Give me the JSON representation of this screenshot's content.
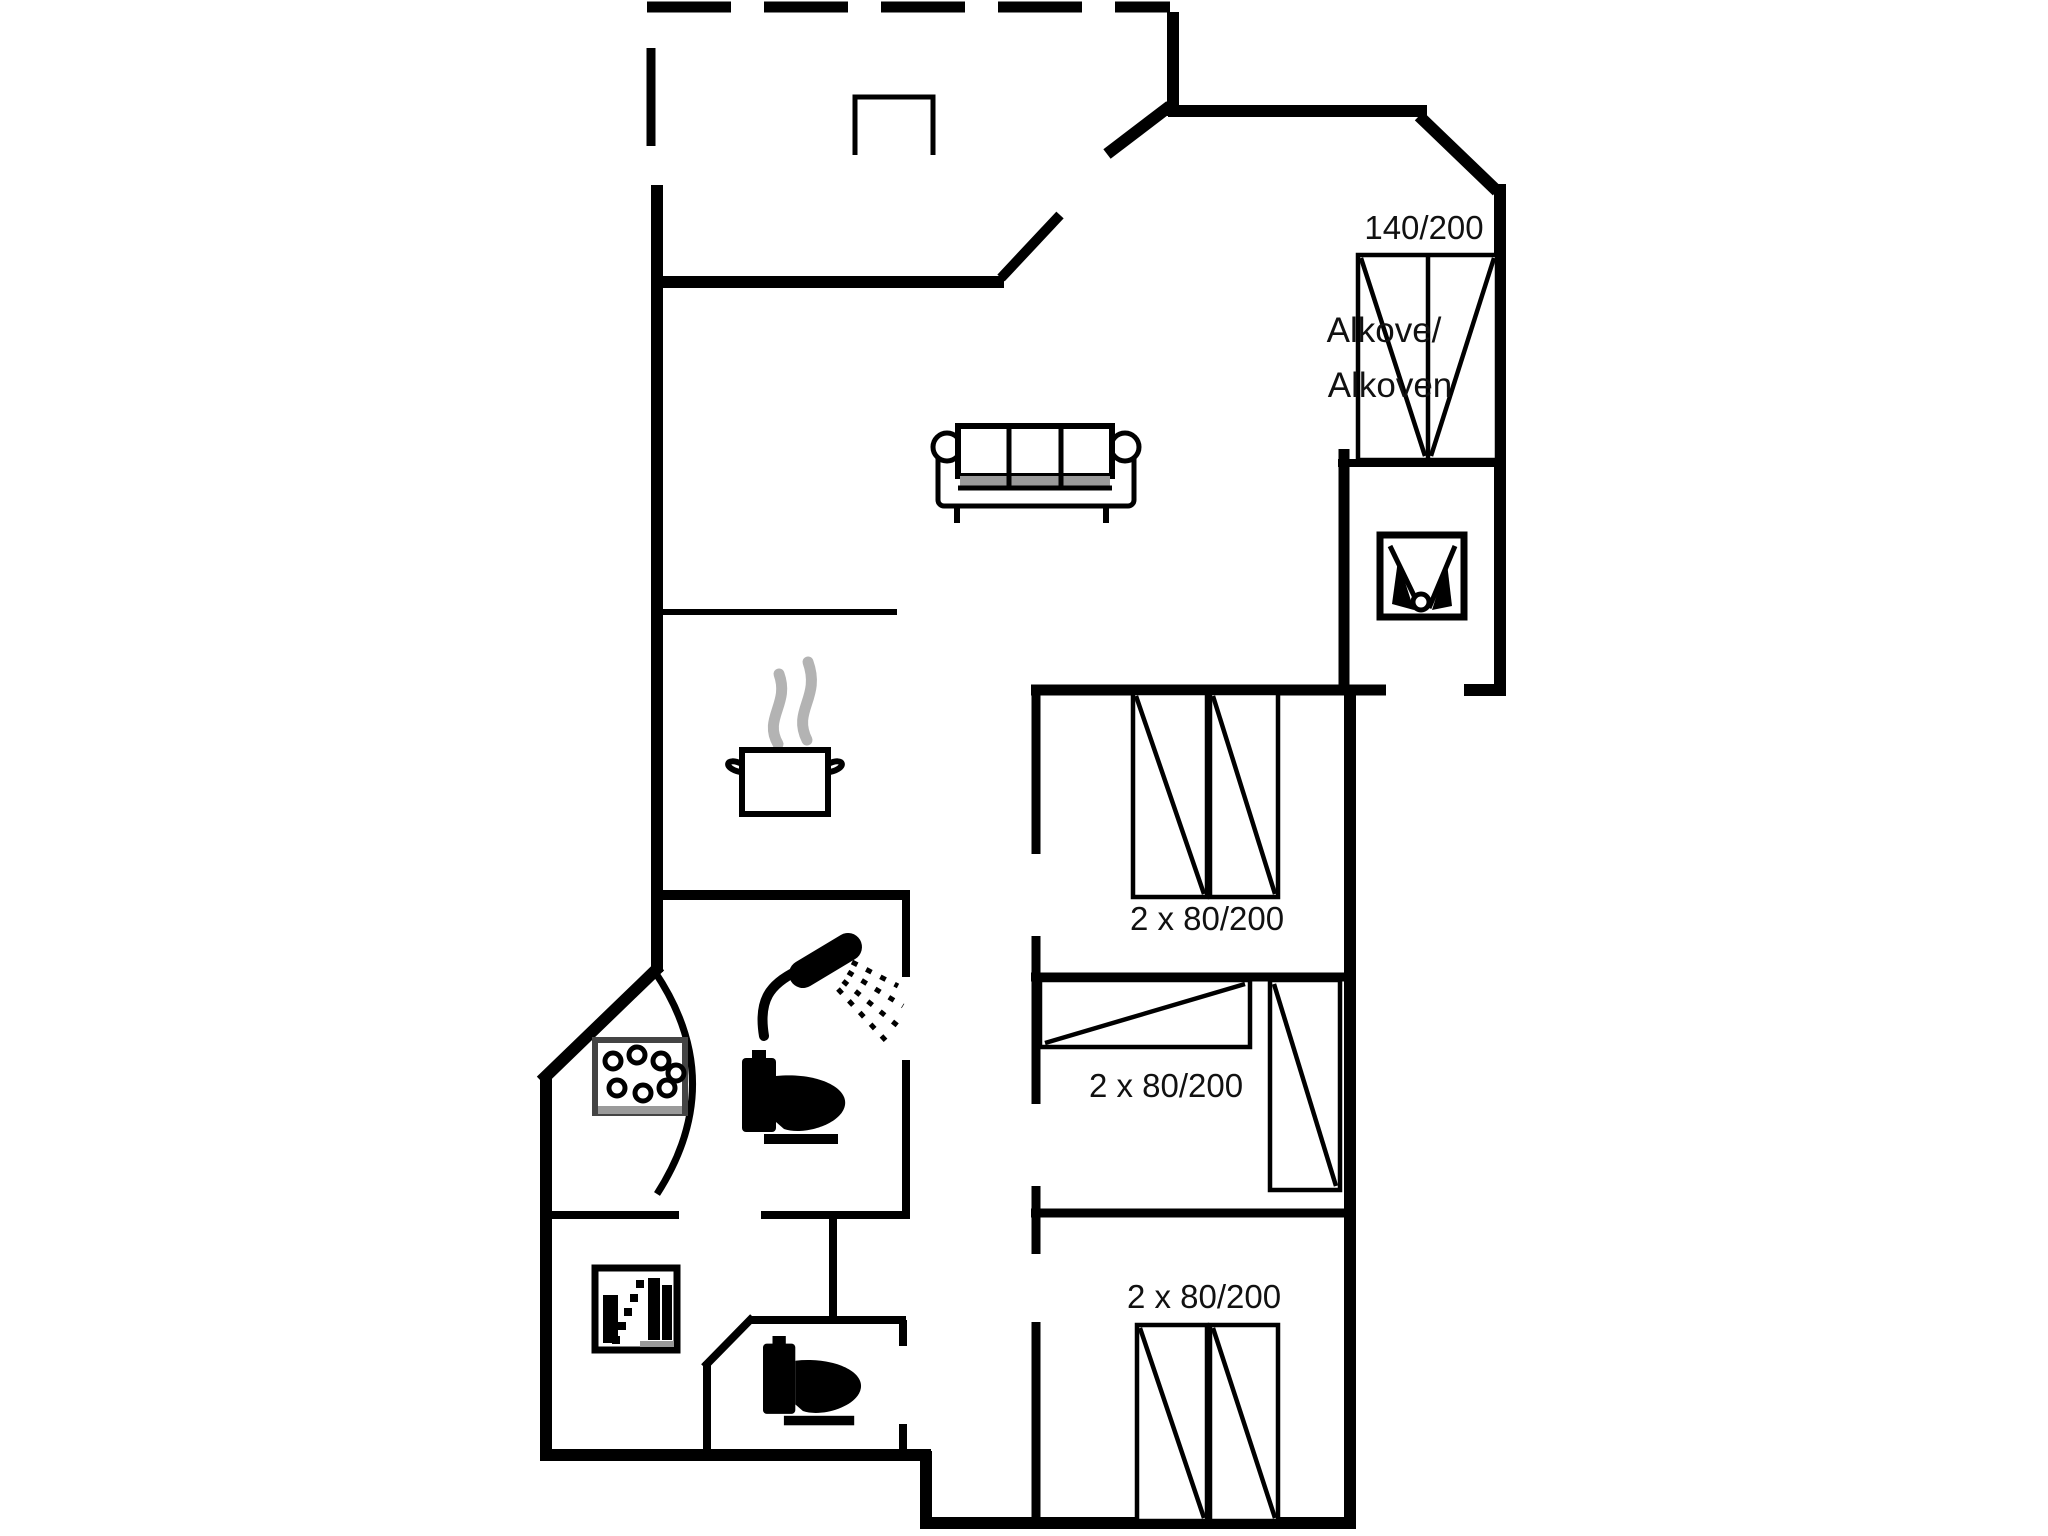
{
  "floorplan": {
    "kind": "holiday-home floor plan",
    "labels": {
      "alkove_bed_size": "140/200",
      "alkove_name_line1": "Alkove/",
      "alkove_name_line2": "Alkoven",
      "bedroom1_bed_size": "2 x 80/200",
      "bedroom2_bed_size": "2 x 80/200",
      "bedroom3_bed_size": "2 x 80/200"
    },
    "colors": {
      "line": "#000000",
      "text": "#111111",
      "steam": "#b3b3b3",
      "shade": "#9a9a9a",
      "background": "#ffffff"
    },
    "icons": [
      {
        "name": "sofa-icon",
        "meaning": "three-seat sofa in living room"
      },
      {
        "name": "cooking-pot-icon",
        "meaning": "kitchen cooking pot with steam"
      },
      {
        "name": "steam-icon",
        "meaning": "steam wisps above pot"
      },
      {
        "name": "shower-icon",
        "meaning": "shower in bathroom"
      },
      {
        "name": "toilet-icon",
        "meaning": "toilet in bathroom"
      },
      {
        "name": "toilet-icon-2",
        "meaning": "toilet in separate wc"
      },
      {
        "name": "spa-bubbles-icon",
        "meaning": "corner whirlpool / spa tub"
      },
      {
        "name": "washing-appliance-icon",
        "meaning": "appliance in utility room"
      },
      {
        "name": "entry-appliance-icon",
        "meaning": "appliance in small room at entrance"
      },
      {
        "name": "double-bed-icon",
        "meaning": "alcove double bed 140/200"
      },
      {
        "name": "single-bed-icon",
        "meaning": "single beds 80/200"
      }
    ]
  }
}
